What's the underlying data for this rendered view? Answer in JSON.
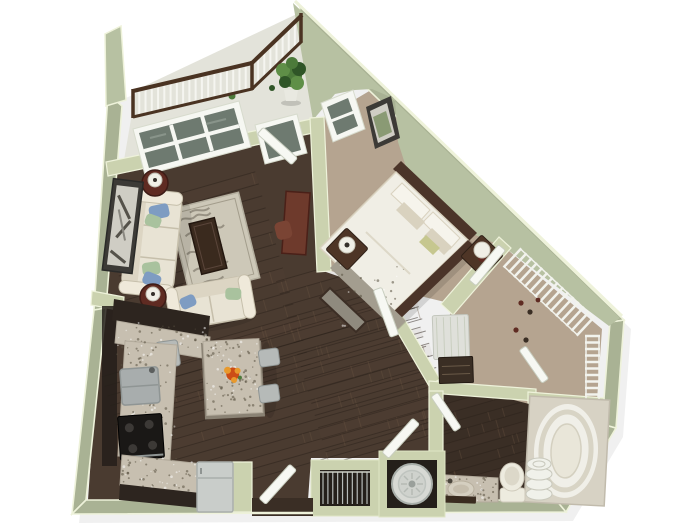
{
  "scene": {
    "kind": "3d-rendered-floor-plan",
    "rooms": [
      "balcony",
      "living-room",
      "kitchen-dining",
      "bedroom",
      "walk-in-closet",
      "bathroom",
      "laundry-closet",
      "coat-closet",
      "entry"
    ]
  },
  "colors": {
    "bg": "#ffffff",
    "shadow": "#000000",
    "wallGreen": "#a9b294",
    "wallInner": "#cbd2af",
    "wallLight": "#b7c1a2",
    "wallCap": "#eef2da",
    "railWood": "#4a3322",
    "baluster": "#f5f5f0",
    "balconyFloor": "#e3e3da",
    "plantDark": "#2f5527",
    "plant": "#4c7a3a",
    "plantLight": "#5f8f47",
    "pot": "#e9e9e1",
    "frameWhite": "#f6f7f2",
    "glass": "#6e7a70",
    "glassLight": "#95a096",
    "doorWhite": "#f7f8f3",
    "doorEdge": "#c9cec0",
    "wood": "#4a3b30",
    "woodDark": "#3a2e25",
    "plankLight": "#6b5542",
    "plankDark": "#2b221b",
    "carpet": "#b5a490",
    "carpetDark": "#a18f7b",
    "rug": "#cdc8b8",
    "rugSwirl": "#8e887a",
    "sofa": "#e8e3d4",
    "sofaEdge": "#c6bfab",
    "sofaLight": "#efe9da",
    "cushionBack": "#dcd5c3",
    "pillowBlue": "#7e9cc2",
    "pillowGreen": "#a9c29e",
    "maroon": "#5f2b22",
    "lampShade": "#f0efe6",
    "lampDark": "#35302a",
    "coffee": "#3a2a1e",
    "desk": "#6e3a2c",
    "deskChair": "#7a4434",
    "art": "#3c3a36",
    "artMat": "#cfcdc4",
    "cabinet": "#2d251f",
    "granite": "#c7bfb0",
    "speck": "#57503f",
    "steel": "#b6bab8",
    "steelDark": "#8f9594",
    "stove": "#1a1816",
    "burner": "#3c3936",
    "fridge": "#c9cdca",
    "bedWhite": "#f0eee5",
    "bedTan": "#d9d2bf",
    "headboard": "#4b3429",
    "runner": "#a39d8f",
    "olive": "#c6c78f",
    "bench": "#8f8a7e",
    "benchEdge": "#3c2e25",
    "nightstand": "#4e3526",
    "shelfWhite": "#f2f3ed",
    "hamper": "#dfe0da",
    "chest": "#3a2e24",
    "tub": "#f0efe8",
    "tubRing": "#d8d4c5",
    "surround": "#d7d2c4",
    "toilet": "#edebdf",
    "towel": "#f0f1ea",
    "washer": "#d7d9d4",
    "washerRim": "#a9afaa",
    "orange": "#cc4d16",
    "orange2": "#e8992c",
    "landscape": "#8a9a74",
    "darkFloorShade": "#241f1a"
  }
}
